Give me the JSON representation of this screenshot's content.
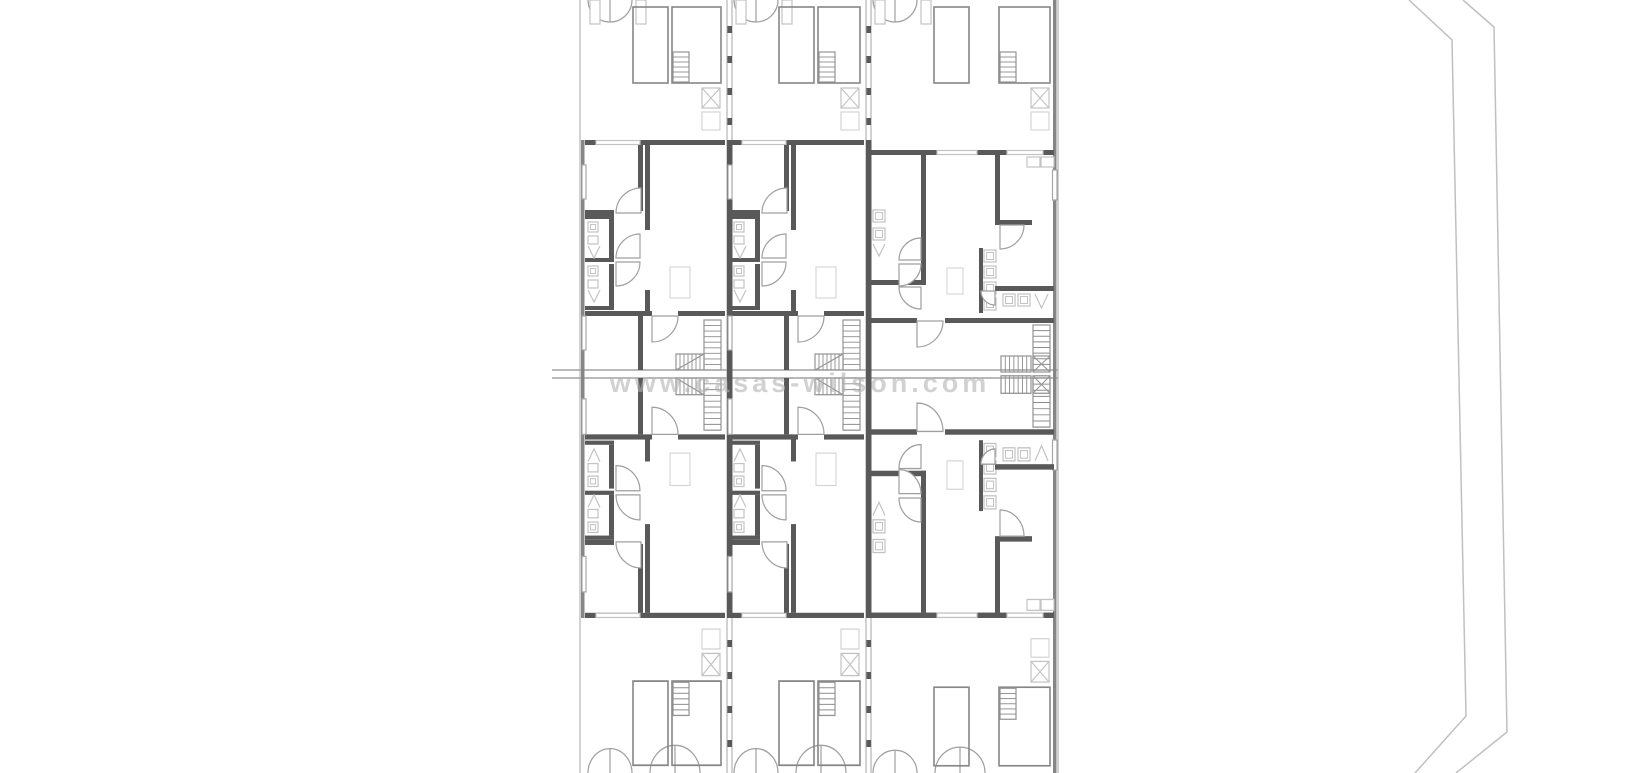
{
  "figure": {
    "type": "architectural-floor-plan",
    "description": "Black and white floor plan of three adjoining townhouse units, mirrored top and bottom, with garage strips at the outer edges, central stair band, and a plot boundary line on the right side"
  },
  "watermark": {
    "text": "www.casas-wilson.com"
  },
  "palette": {
    "background": "#ffffff",
    "wall_dark": "#595959",
    "wall_mid": "#868686",
    "line_light": "#a6a6a6",
    "frame": "#949494",
    "fixture": "#c3c3c3",
    "faint": "#d4d4d4",
    "tread": "#8d8d8d",
    "arc": "#9f9f9f",
    "watermark": "#b4b4b4",
    "boundary": "#c0c0c0"
  },
  "plan": {
    "canvas": {
      "w": 1638,
      "h": 773
    },
    "columns": [
      {
        "x": 582,
        "w": 146,
        "unit_y": 140,
        "unit_h": 230,
        "garage_h": 140,
        "variant": "A"
      },
      {
        "x": 728,
        "w": 139,
        "unit_y": 140,
        "unit_h": 230,
        "garage_h": 140,
        "variant": "A"
      },
      {
        "x": 867,
        "w": 190,
        "unit_y": 150,
        "unit_h": 220,
        "garage_h": 150,
        "variant": "B"
      }
    ],
    "band": {
      "y1": 370,
      "y2": 378,
      "x1": 552,
      "x2": 1058
    },
    "bottom_anchor": 618,
    "strip_bottom": 773,
    "dividers": [
      727,
      866
    ],
    "outer": {
      "left": 580,
      "right": 1053
    },
    "divider_ticks_top": [
      26,
      56,
      88,
      118
    ],
    "divider_ticks_bottom": [
      640,
      672,
      706,
      740
    ],
    "boundary": [
      [
        1409,
        0,
        1452,
        40,
        1466,
        716,
        1415,
        773
      ],
      [
        1463,
        0,
        1494,
        27,
        1507,
        732,
        1456,
        773
      ]
    ],
    "watermark_pos": {
      "x": 800,
      "y": 392,
      "size": 27
    }
  }
}
